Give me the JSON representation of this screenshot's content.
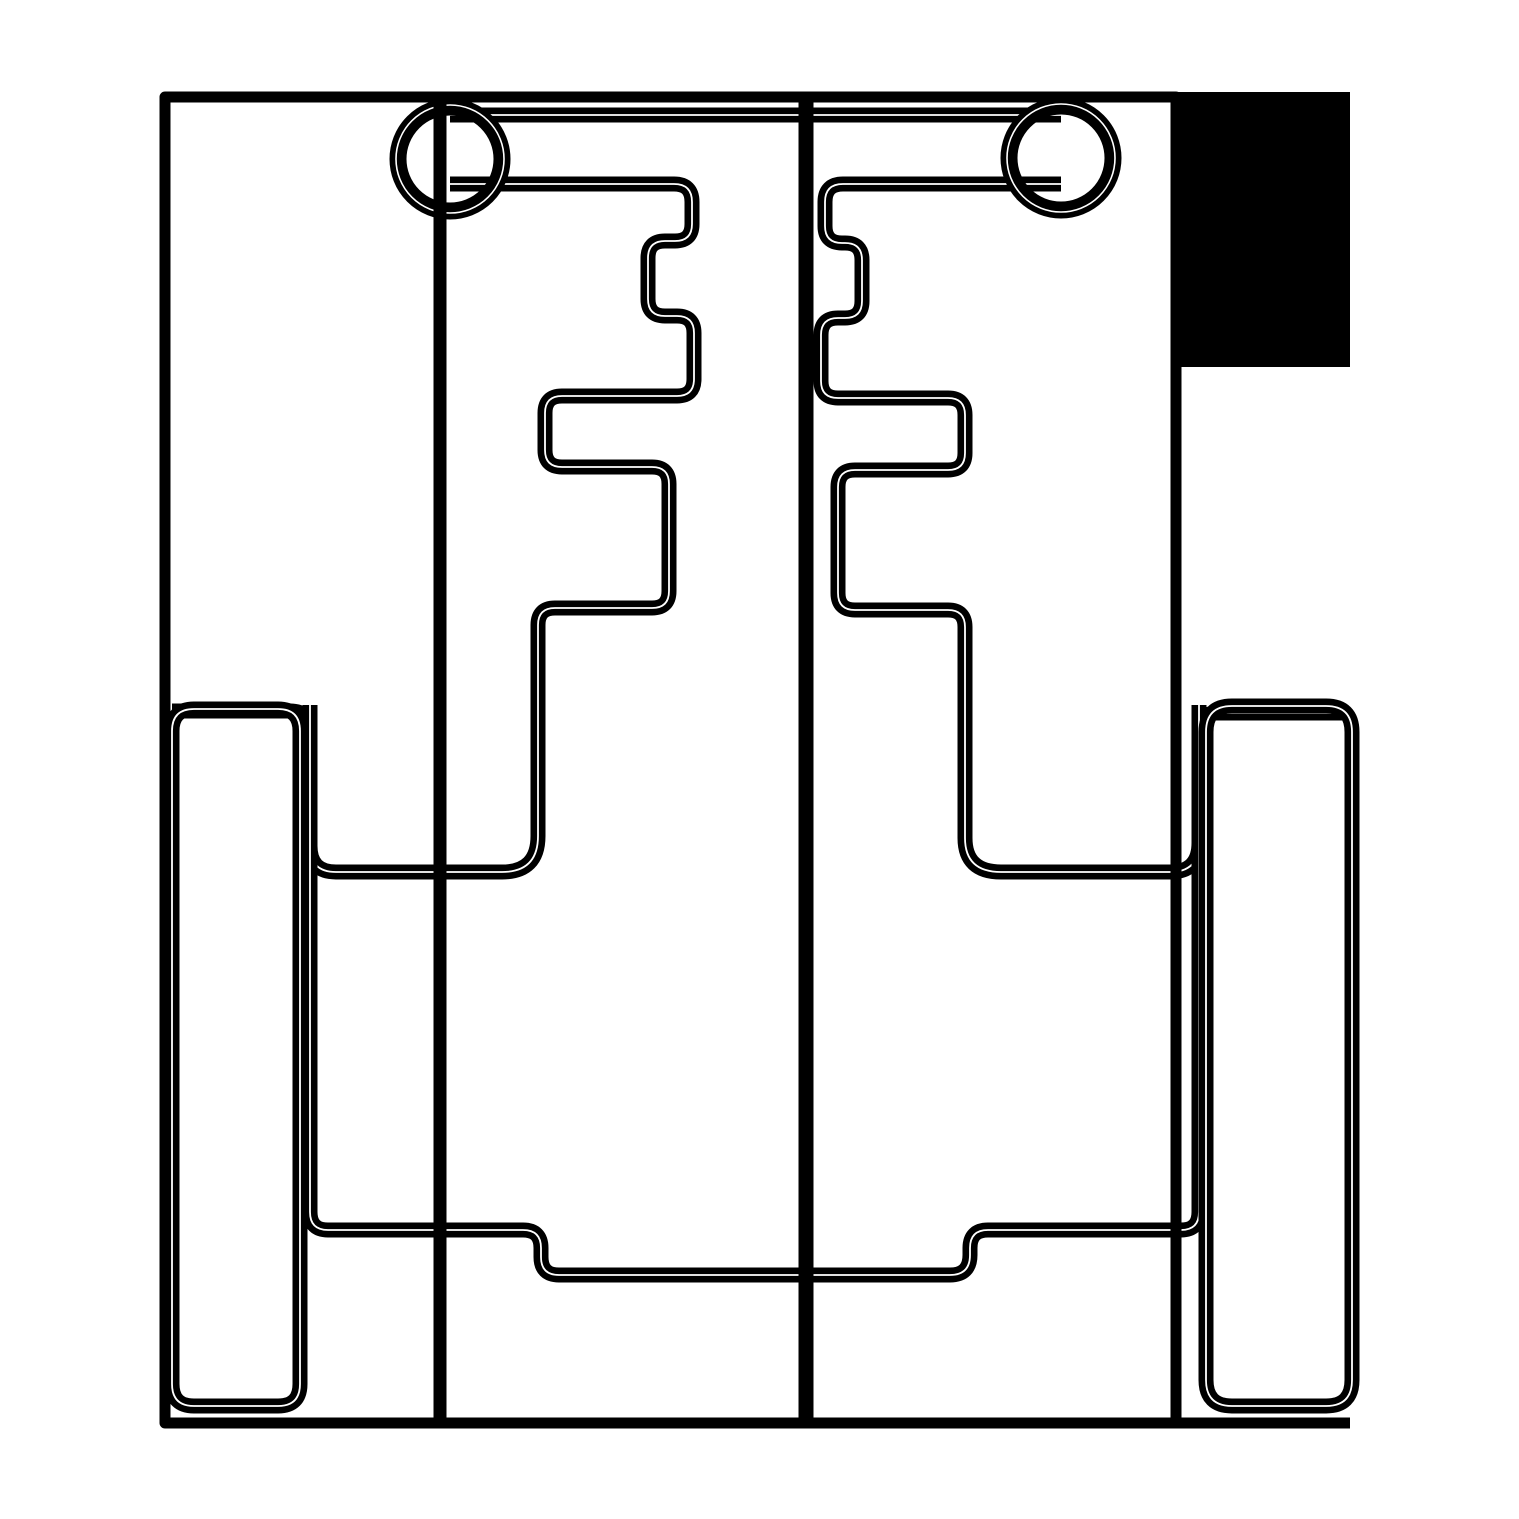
{
  "canvas": {
    "width": 1519,
    "height": 1519,
    "background_color": "#ffffff",
    "ink_color": "#000000"
  },
  "drawing": {
    "kind": "monochrome technical line drawing / cut-pattern template",
    "stroke_style": "thick black strokes with thin white hairline core (double-stroke)",
    "shapes": [
      {
        "name": "corner-fill-block",
        "type": "rect",
        "x": 1172,
        "y": 92,
        "w": 178,
        "h": 275
      },
      {
        "name": "top-crossbar-line",
        "type": "path",
        "d": "M450,115 H1061",
        "width": 15,
        "core": 1.8
      },
      {
        "name": "left-stepped-channel",
        "type": "path",
        "d": "M450,184 H674 Q692,184 692,202 V224 Q692,241 675,241 H665 Q648,241 648,258 V299 Q648,316 665,316 H677 Q694,316 694,333 V379 Q694,396 677,396 H562 Q545,396 545,413 V450 Q545,467 562,467 H652 Q669,467 669,484 V591 Q669,608 652,608 H555 Q538,608 538,625 V836 Q538,872 502,872 H336 Q310,872 310,846 V731 Q310,711 290,711 H172",
        "width": 15,
        "core": 1.8
      },
      {
        "name": "right-stepped-channel",
        "type": "path",
        "d": "M1061,184 H843 Q825,184 825,202 V226 Q825,243 842,243 H845 Q862,243 862,260 V301 Q862,318 845,318 H838 Q821,318 821,335 V381 Q821,398 838,398 H948 Q965,398 965,415 V453 Q965,470 948,470 H855 Q838,470 838,487 V593 Q838,610 855,610 H948 Q965,610 965,627 V838 Q965,872 1001,872 H1170 Q1199,872 1199,843 V731 Q1199,713 1217,713 H1345",
        "width": 15,
        "core": 1.8
      },
      {
        "name": "lower-channel-path",
        "type": "path",
        "d": "M310,705 V1212 Q310,1230 328,1230 H523 Q541,1230 541,1248 V1257 Q541,1275 559,1275 H950 Q970,1275 970,1255 V1248 Q970,1230 988,1230 H1181 Q1199,1230 1199,1212 V705",
        "width": 15,
        "core": 1.8
      },
      {
        "name": "left-side-rail",
        "type": "path",
        "d": "M194,709 H278 Q300,709 300,731 V1384 Q300,1406 278,1406 H194 Q172,1406 172,1384 V731 Q172,709 194,709 Z",
        "width": 15,
        "core": 1.8
      },
      {
        "name": "right-side-rail",
        "type": "path",
        "d": "M1232,706 H1326 Q1352,706 1352,732 V1380 Q1352,1406 1326,1406 H1232 Q1206,1406 1206,1380 V732 Q1206,706 1232,706 Z",
        "width": 15,
        "core": 1.8
      },
      {
        "name": "left-grommet-ring",
        "type": "ring",
        "cx": 450,
        "cy": 159,
        "r": 52,
        "width": 17,
        "hair_r": 54,
        "core": 1.6
      },
      {
        "name": "right-grommet-ring",
        "type": "ring",
        "cx": 1061,
        "cy": 158,
        "r": 52,
        "width": 17,
        "hair_r": 54,
        "core": 1.6
      },
      {
        "name": "outer-border",
        "type": "path",
        "d": "M1350,1423 H165 V97 H1176 V1423",
        "width": 11,
        "core": 0
      },
      {
        "name": "left-guide-line",
        "type": "path",
        "d": "M440,97 V1423",
        "width": 13,
        "core": 0
      },
      {
        "name": "center-divider-line",
        "type": "path",
        "d": "M806,97 V1423",
        "width": 15,
        "core": 0
      }
    ]
  }
}
